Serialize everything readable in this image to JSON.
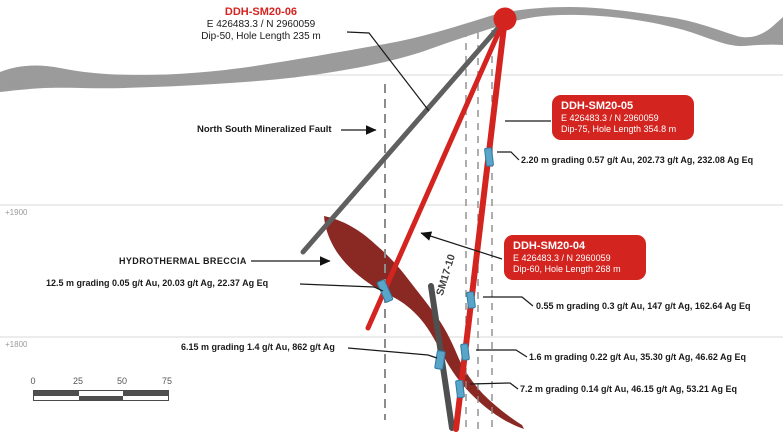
{
  "diagram": {
    "elevations": {
      "e2000": "+2000",
      "e1900": "+1900",
      "e1800": "+1800"
    },
    "scale_bar": {
      "ticks": [
        "0",
        "25",
        "50",
        "75"
      ]
    },
    "holes": {
      "sm20_06": {
        "name": "DDH-SM20-06",
        "coords": "E 426483.3 / N 2960059",
        "spec": "Dip-50, Hole Length 235 m"
      },
      "sm20_05": {
        "name": "DDH-SM20-05",
        "coords": "E 426483.3 / N 2960059",
        "spec": "Dip-75, Hole Length 354.8 m"
      },
      "sm20_04": {
        "name": "DDH-SM20-04",
        "coords": "E 426483.3 / N 2960059",
        "spec": "Dip-60, Hole Length 268 m"
      },
      "sm17_10": {
        "name": "SM17-10"
      }
    },
    "features": {
      "fault_label": "North South Mineralized Fault",
      "breccia_label": "HYDROTHERMAL BRECCIA"
    },
    "intervals": {
      "i220": "2.20 m grading 0.57 g/t Au, 202.73 g/t Ag, 232.08 Ag Eq",
      "i125": "12.5 m grading 0.05 g/t Au, 20.03 g/t Ag, 22.37 Ag Eq",
      "i055": "0.55 m grading 0.3 g/t Au, 147 g/t Ag, 162.64 Ag Eq",
      "i615": "6.15 m grading 1.4 g/t Au, 862 g/t Ag",
      "i160": "1.6 m grading 0.22 g/t Au, 35.30 g/t Ag, 46.62 Ag Eq",
      "i720": "7.2 m grading 0.14 g/t Au, 46.15 g/t Ag, 53.21 Ag Eq"
    },
    "colors": {
      "drill_red": "#d42420",
      "breccia_maroon": "#8a2823",
      "terrain_gray": "#9b9b9b",
      "historic_hole_gray": "#4f4f4f",
      "interval_marker_blue": "#58a5c9",
      "dashed_fault_gray": "#8c8c8c"
    }
  }
}
